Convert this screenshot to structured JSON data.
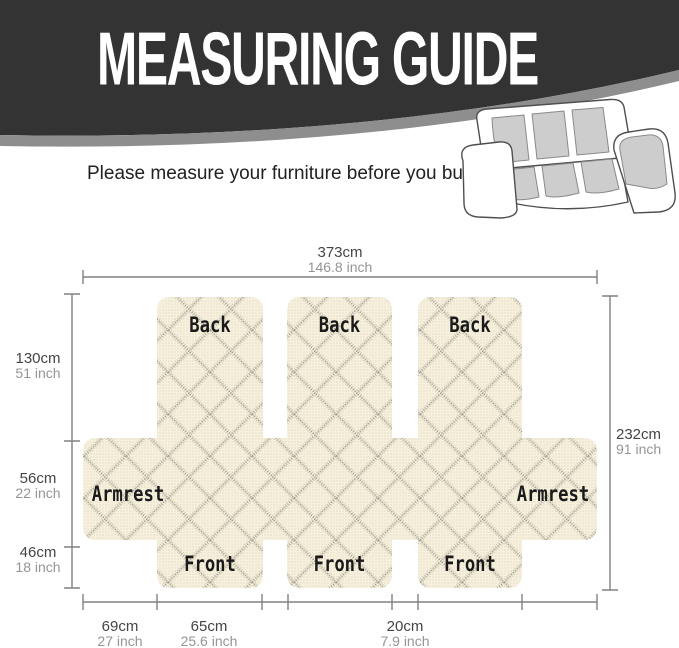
{
  "banner": {
    "title": "MEASURING GUIDE",
    "bg_color": "#333333",
    "swoosh_color": "#8e8e8e"
  },
  "subtitle": "Please measure your furniture before you buy.",
  "panels": {
    "back": [
      "Back",
      "Back",
      "Back"
    ],
    "front": [
      "Front",
      "Front",
      "Front"
    ],
    "armrest": [
      "Armrest",
      "Armrest"
    ]
  },
  "dims": {
    "width_total": {
      "cm": "373cm",
      "inch": "146.8 inch"
    },
    "back_height": {
      "cm": "130cm",
      "inch": "51 inch"
    },
    "armrest_height": {
      "cm": "56cm",
      "inch": "22 inch"
    },
    "front_height": {
      "cm": "46cm",
      "inch": "18 inch"
    },
    "depth_total": {
      "cm": "232cm",
      "inch": "91 inch"
    },
    "armrest_width": {
      "cm": "69cm",
      "inch": "27 inch"
    },
    "seat_width": {
      "cm": "65cm",
      "inch": "25.6 inch"
    },
    "gap_width": {
      "cm": "20cm",
      "inch": "7.9 inch"
    }
  },
  "colors": {
    "fabric": "#f6f0dc",
    "fabric_line": "#8a8474",
    "dim_line": "#808080",
    "cm_text": "#454545",
    "inch_text": "#959595",
    "label_text": "#1a1a1a"
  }
}
